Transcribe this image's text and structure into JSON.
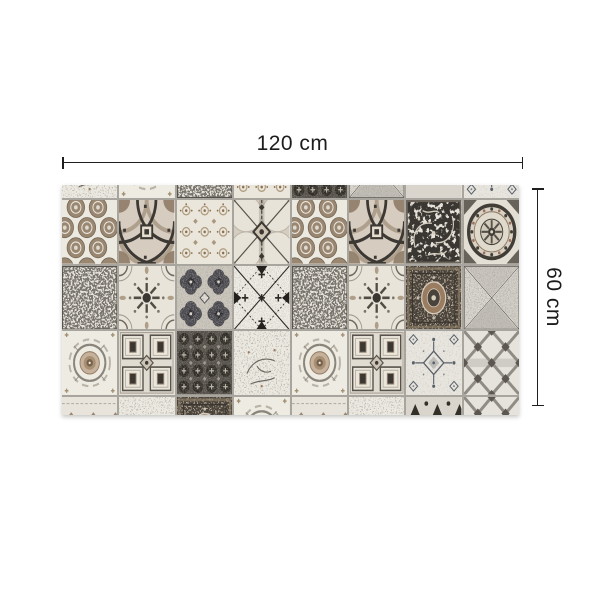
{
  "dimensions": {
    "width_label": "120 cm",
    "height_label": "60 cm"
  },
  "style": {
    "canvas_bg": "#ffffff",
    "line_color": "#1f1f1f",
    "text_color": "#1c1c1c",
    "grout_color": "#a8a49e",
    "tile_cream": "#ece9e1",
    "tile_taupe": "#9a8772",
    "tile_charcoal": "#3a3632",
    "tile_bluegray": "#596068"
  },
  "rug": {
    "name": "patchwork-vintage-tile-mat",
    "grid": {
      "columns": 8,
      "top_strip": [
        "sketch",
        "rose",
        "maze",
        "lattice",
        "darkfloral",
        "trianglespeck",
        "zigzagdark",
        "damaskcross"
      ],
      "rows": [
        [
          "circles",
          "frame",
          "lattice",
          "compass",
          "circles",
          "frame",
          "damaskdark",
          "mandala"
        ],
        [
          "maze",
          "floralmandala",
          "quatrefoil",
          "diagcross",
          "maze",
          "floralmandala",
          "carpet",
          "trianglespeck"
        ],
        [
          "rose",
          "ninesq",
          "darkfloral",
          "sketch",
          "rose",
          "ninesq",
          "damaskcross",
          "trellis"
        ]
      ],
      "bottom_strip": [
        "chevron",
        "sketch",
        "carpet",
        "rose",
        "chevron",
        "sketch",
        "zigzagdark",
        "trellis"
      ]
    }
  }
}
